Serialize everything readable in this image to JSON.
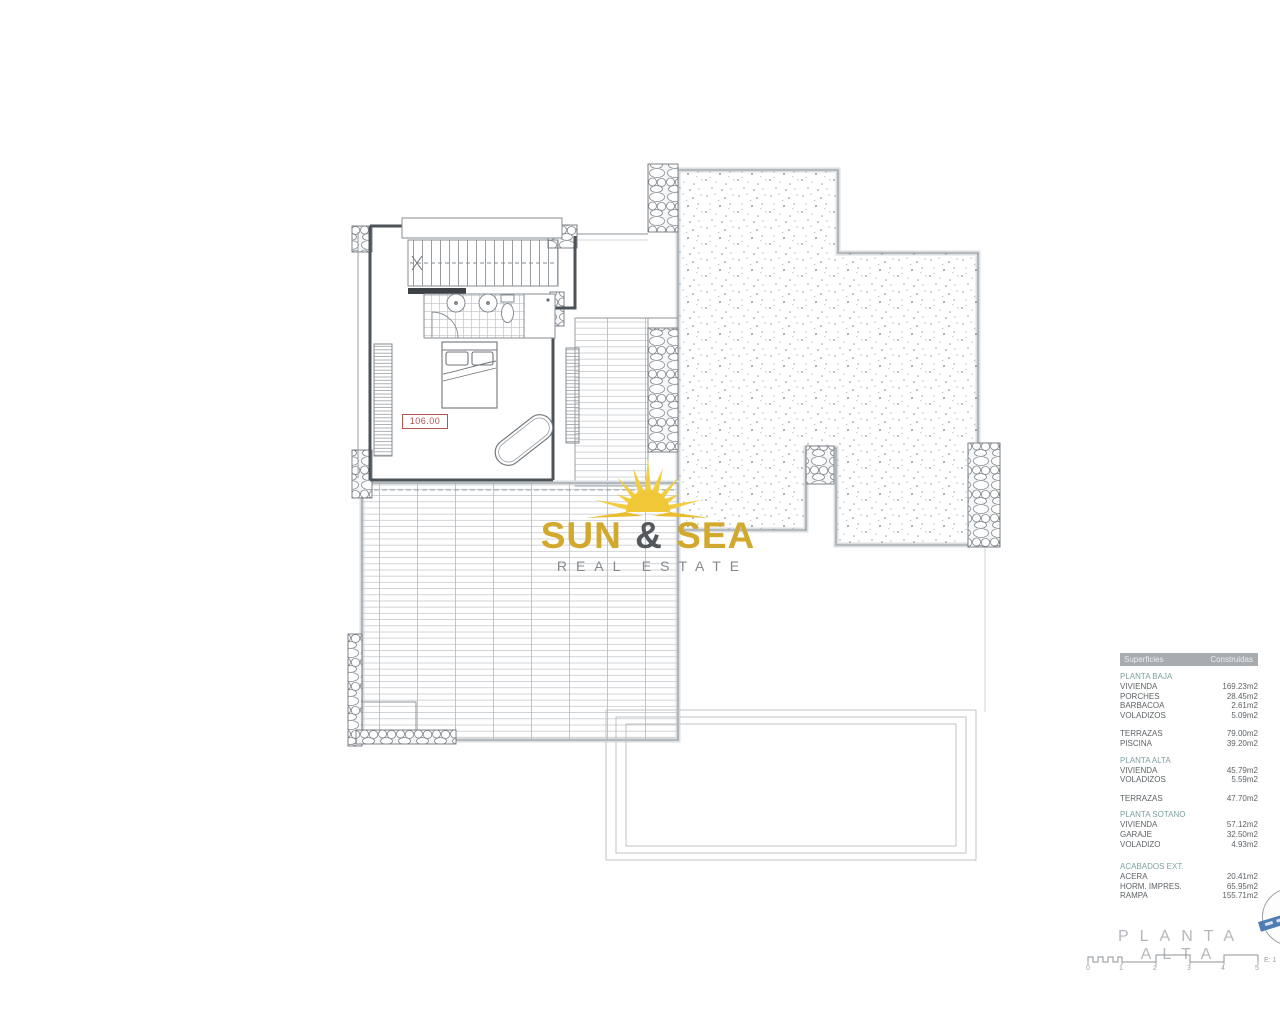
{
  "plan": {
    "room_area_label": "106.00"
  },
  "logo": {
    "word1": "SUN",
    "ampersand": "&",
    "word2": "SEA",
    "tagline": "REAL ESTATE"
  },
  "areas_table": {
    "header": {
      "col_label": "Superficies",
      "col_value": "Construidas"
    },
    "sections": [
      {
        "title": "PLANTA BAJA",
        "rows": [
          {
            "label": "VIVIENDA",
            "value": "169.23m2"
          },
          {
            "label": "PORCHES",
            "value": "28.45m2"
          },
          {
            "label": "BARBACOA",
            "value": "2.61m2"
          },
          {
            "label": "VOLADIZOS",
            "value": "5.09m2"
          }
        ]
      },
      {
        "title": "",
        "rows": [
          {
            "label": "TERRAZAS",
            "value": "79.00m2"
          },
          {
            "label": "PISCINA",
            "value": "39.20m2"
          }
        ]
      },
      {
        "title": "PLANTA ALTA",
        "rows": [
          {
            "label": "VIVIENDA",
            "value": "45.79m2"
          },
          {
            "label": "VOLADIZOS",
            "value": "5.59m2"
          }
        ]
      },
      {
        "title": "",
        "rows": [
          {
            "label": "TERRAZAS",
            "value": "47.70m2"
          }
        ]
      },
      {
        "title": "PLANTA SOTANO",
        "rows": [
          {
            "label": "VIVIENDA",
            "value": "57.12m2"
          },
          {
            "label": "GARAJE",
            "value": "32.50m2"
          },
          {
            "label": "VOLADIZO",
            "value": "4.93m2"
          }
        ]
      },
      {
        "title": "ACABADOS EXT.",
        "rows": [
          {
            "label": "ACERA",
            "value": "20.41m2"
          },
          {
            "label": "HORM. IMPRES.",
            "value": "65.95m2"
          },
          {
            "label": "RAMPA",
            "value": "155.71m2"
          }
        ]
      }
    ]
  },
  "title_block": {
    "title": "PLANTA ALTA",
    "scale_label": "E: 1",
    "scale_ticks": [
      "0",
      "1",
      "2",
      "3",
      "4",
      "5"
    ]
  },
  "colors": {
    "accent_gold": "#d2a92c",
    "red_label": "#b5534f",
    "section_teal": "#7fa0a0",
    "table_header_bg": "#a7acb1",
    "stamp_band_blue": "#4f7db3"
  }
}
